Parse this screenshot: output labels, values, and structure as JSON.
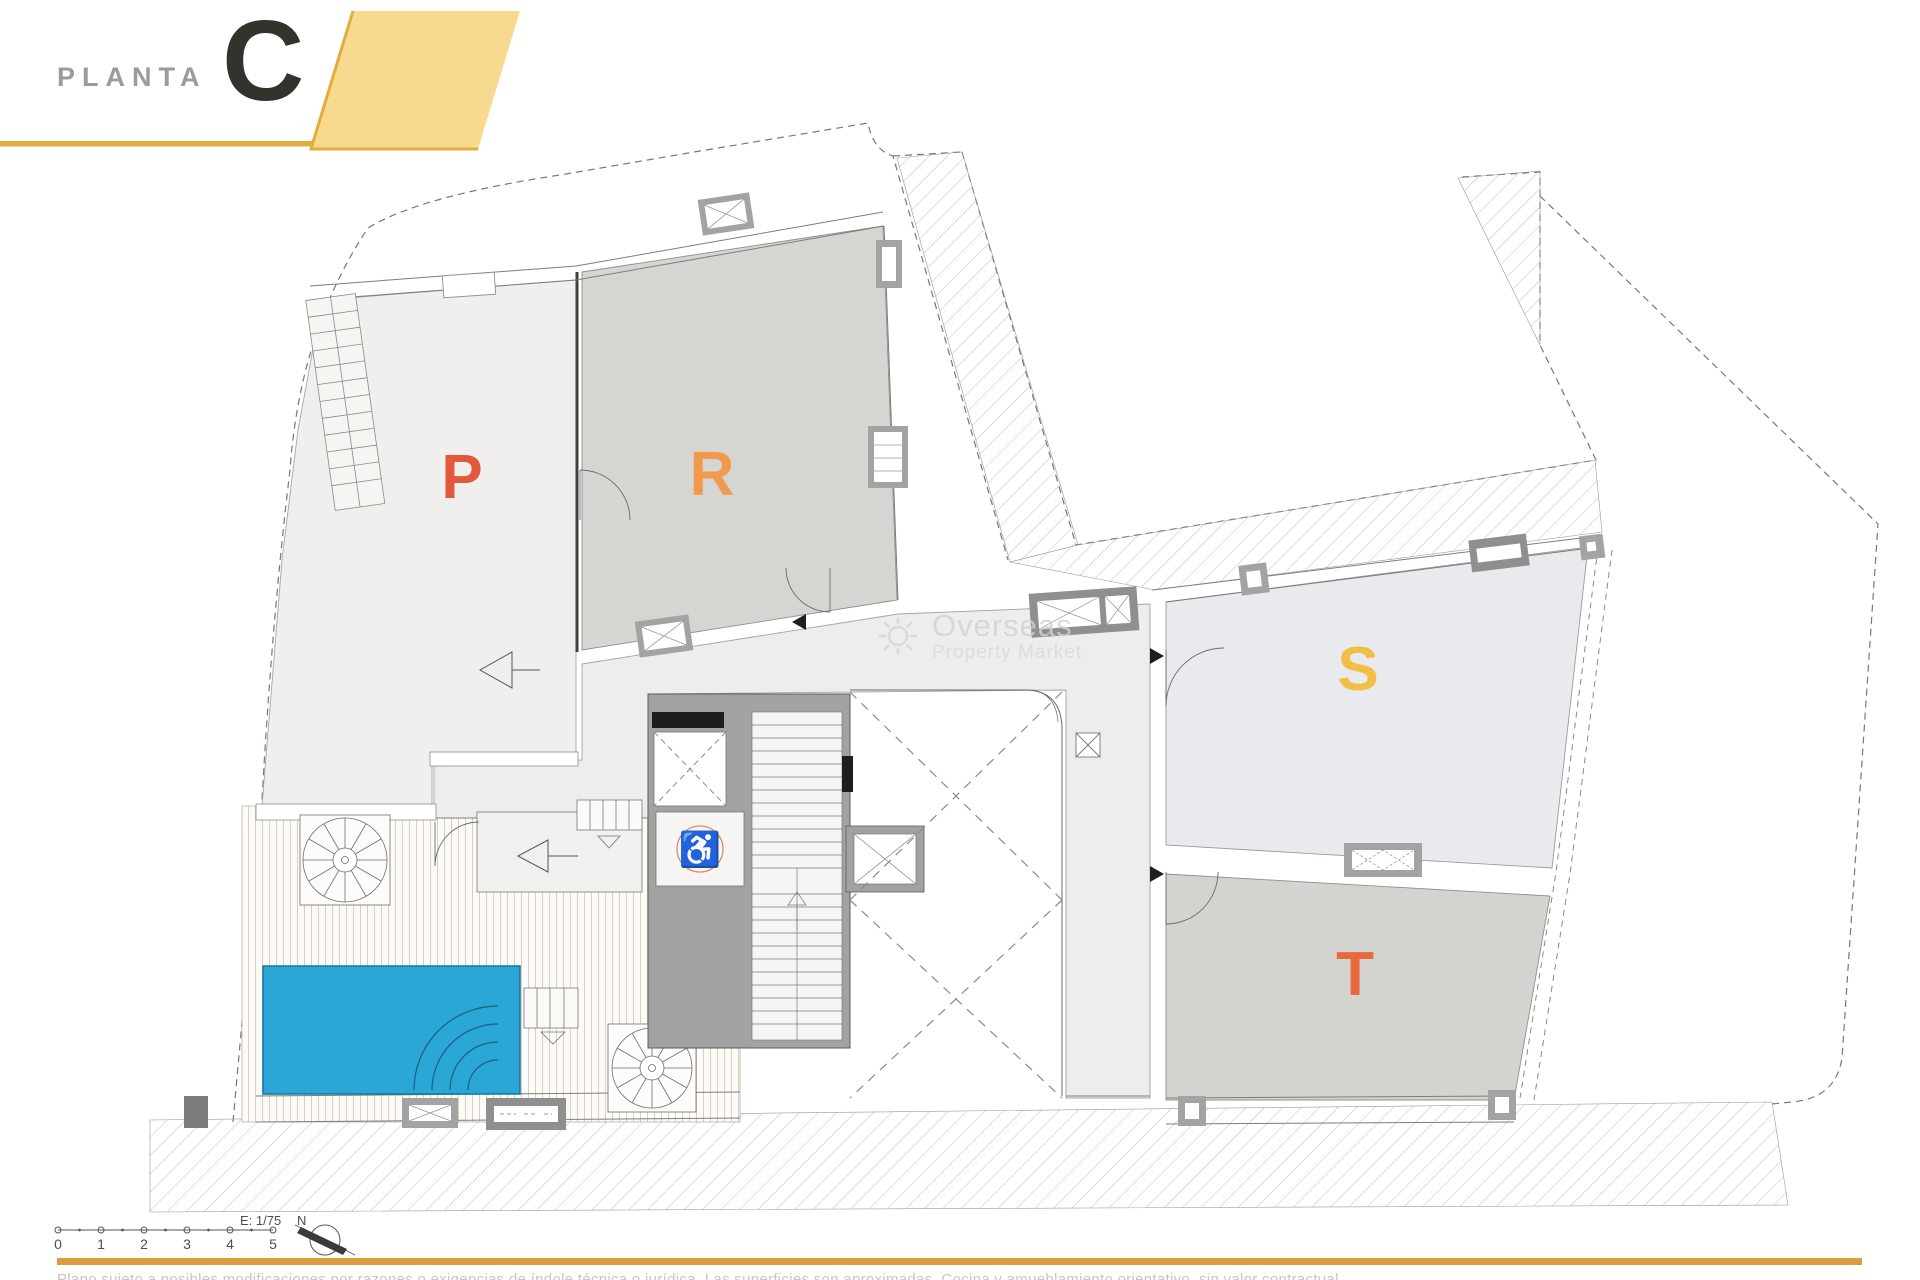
{
  "header": {
    "plan_word": "PLANTA",
    "floor_letter": "C"
  },
  "plan": {
    "area_labels": {
      "p": "P",
      "r": "R",
      "s": "S",
      "t": "T"
    },
    "wheelchair_icon": "♿"
  },
  "watermark": {
    "line1": "Overseas",
    "line2": "Property Market"
  },
  "scale_bar": {
    "scale_label": "E: 1/75",
    "tick_labels": [
      "0",
      "1",
      "2",
      "3",
      "4",
      "5"
    ],
    "north_label": "N"
  },
  "footer": {
    "disclaimer": "Plano sujeto a posibles modificaciones por razones o exigencias de índole técnica o jurídica. Las superficies son aproximadas. Cocina y amueblamiento orientativo, sin valor contractual."
  },
  "colors": {
    "accent_yellow_fill": "#F8DA8E",
    "accent_yellow_border": "#E2AC3F",
    "orange_rule": "#DC9B40",
    "letter_p": "#E2583C",
    "letter_r": "#F29A4B",
    "letter_s": "#F2BE45",
    "letter_t": "#E9693D",
    "pool_blue": "#2AA7D6",
    "wheelchair_orange": "#C9722F"
  }
}
